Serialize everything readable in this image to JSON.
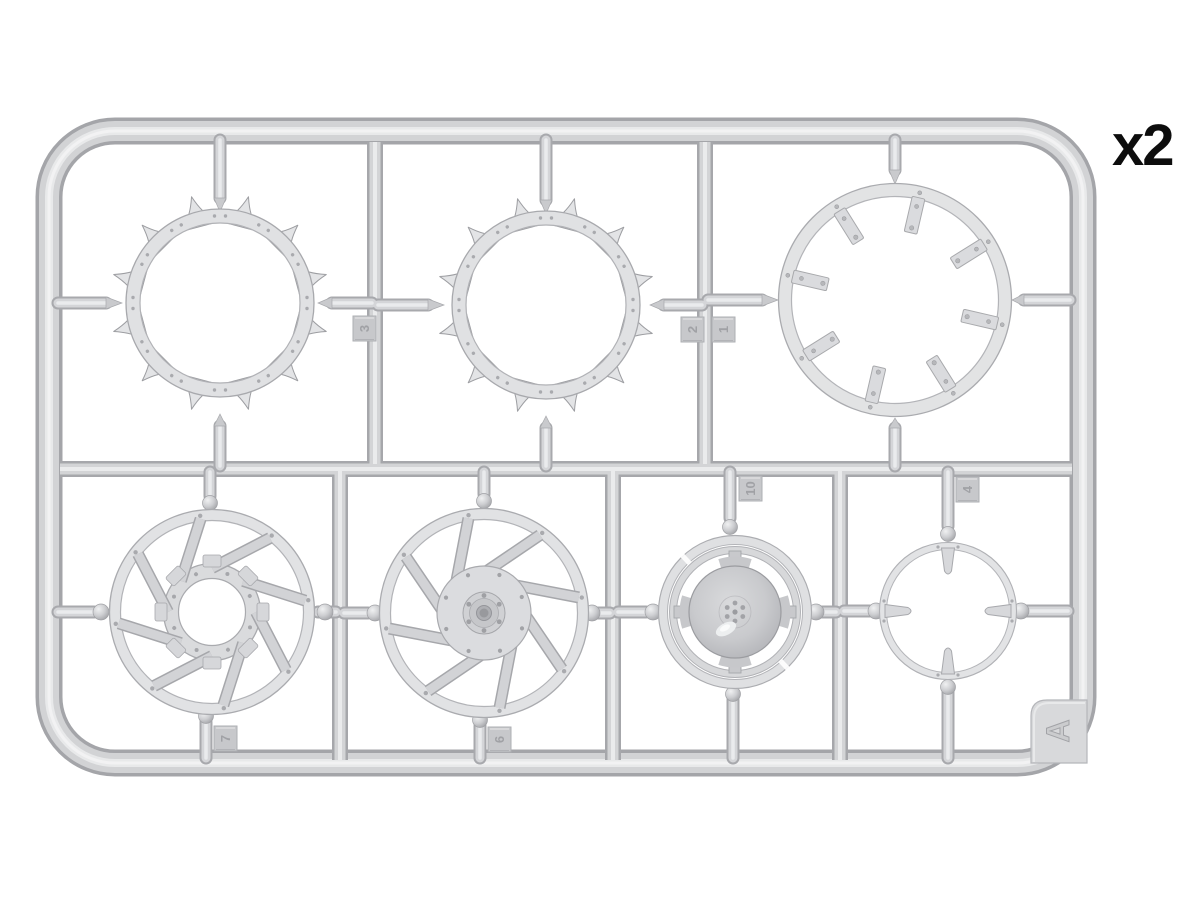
{
  "photo": {
    "background": "#ffffff",
    "subject": "injection-molded plastic model kit sprue with wheel parts",
    "plastic_color": "#d3d4d6",
    "label_color": "#0d0d0d"
  },
  "sprue": {
    "quantity_label": "x2",
    "letter": "A",
    "part_tags": [
      {
        "label": "3",
        "location": "top row, right of first toothed sprocket ring"
      },
      {
        "label": "2",
        "location": "top row, left side of middle divider runner"
      },
      {
        "label": "1",
        "location": "top row, right side of middle divider runner"
      },
      {
        "label": "10",
        "location": "bottom row, above domed-hub wheel"
      },
      {
        "label": "4",
        "location": "bottom row, above four-stub ring"
      },
      {
        "label": "7",
        "location": "bottom row, below open-hub spoked wheel"
      },
      {
        "label": "6",
        "location": "bottom row, below hub-cap spoked wheel"
      }
    ],
    "parts": [
      "toothed sprocket ring (top left)",
      "toothed sprocket ring (top middle)",
      "large ring with eight inner tabs (top right)",
      "eight-spoke wheel with open hub (bottom left)",
      "eight-spoke wheel with bolted hub cap (bottom middle-left)",
      "wheel with domed hub and four cross arms (bottom middle-right)",
      "thin ring with four inner stubs (bottom right)"
    ]
  }
}
